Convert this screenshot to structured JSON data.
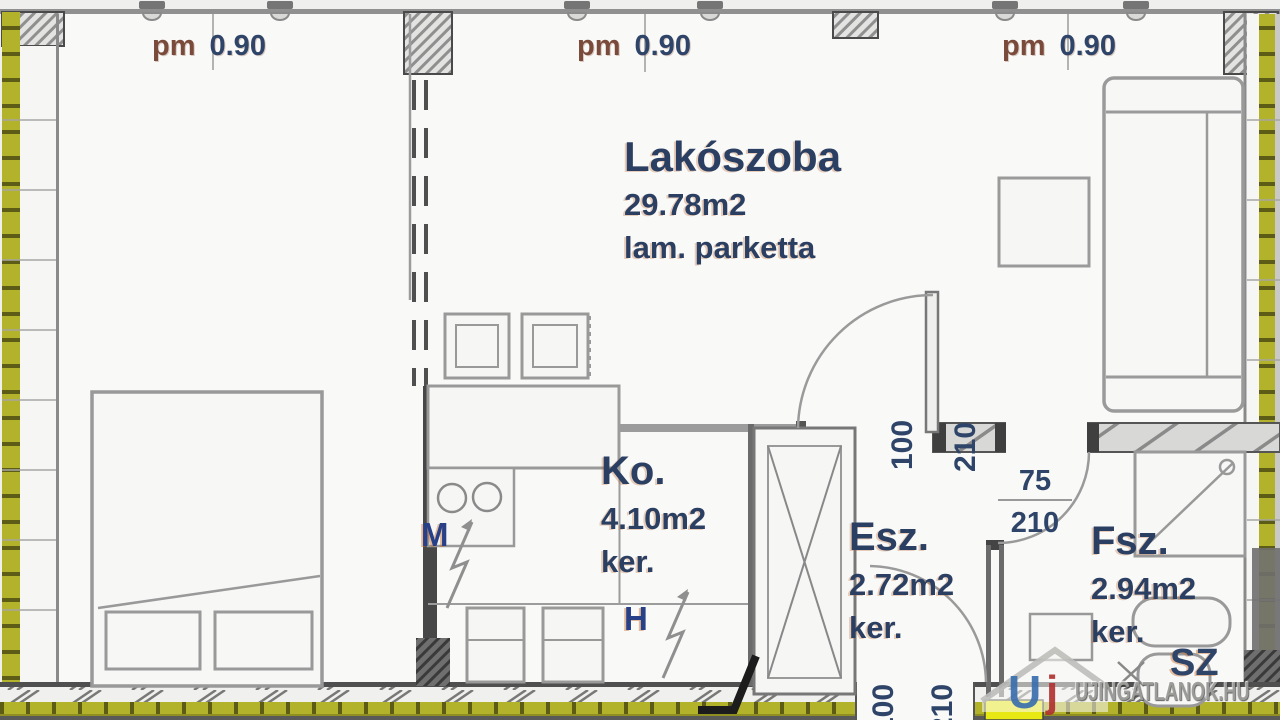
{
  "floor_plan": {
    "window_label": {
      "prefix": "pm",
      "value": "0.90"
    },
    "rooms": {
      "living": {
        "name": "Lakószoba",
        "area": "29.78m2",
        "floor": "lam. parketta"
      },
      "kitchen": {
        "name": "Ko.",
        "area": "4.10m2",
        "floor": "ker."
      },
      "hall": {
        "name": "Esz.",
        "area": "2.72m2",
        "floor": "ker."
      },
      "bathroom": {
        "name": "Fsz.",
        "area": "2.94m2",
        "floor": "ker."
      }
    },
    "appliance_labels": {
      "washer": "M",
      "fridge": "H",
      "dryer": "SZ"
    },
    "doors": {
      "living_hall": {
        "width": "100",
        "height": "210"
      },
      "bathroom": {
        "width": "75",
        "height": "210"
      },
      "entry": {
        "width": "100",
        "height": "210"
      }
    }
  },
  "watermark": {
    "text": "UJINGATLANOK.HU",
    "logo_u": "U",
    "logo_j": "j"
  },
  "colors": {
    "insulation_olive": "#b2b22b",
    "wall_dark": "#474747",
    "label_navy": "#2b3f63",
    "label_brown": "#7a4a3a",
    "watermark_blue": "#3a6fae",
    "watermark_red": "#b03231",
    "highlight_yellow": "#e8e815"
  }
}
